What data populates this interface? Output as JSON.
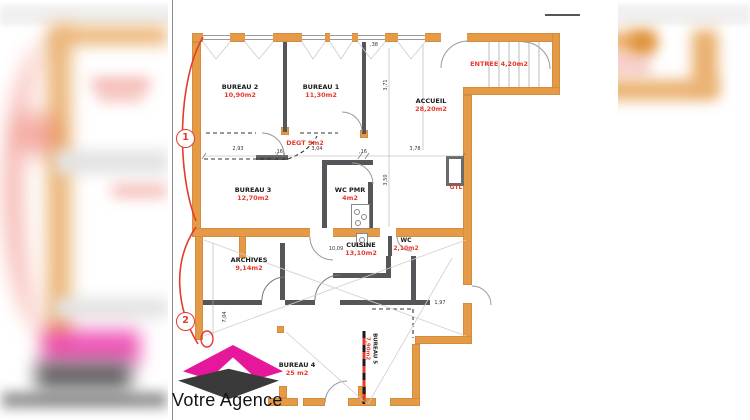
{
  "colors": {
    "wall": "#E49A47",
    "accent_red": "#E63A2E",
    "logo_pink": "#E5179B",
    "logo_dark": "#3A3A3A",
    "partition": "#56565A"
  },
  "plan": {
    "rooms": {
      "bureau2": {
        "name": "BUREAU 2",
        "area": "10,90m2"
      },
      "bureau1": {
        "name": "BUREAU 1",
        "area": "11,30m2"
      },
      "accueil": {
        "name": "ACCUEIL",
        "area": "28,20m2"
      },
      "entree": {
        "label": "ENTREE 4,20m2"
      },
      "degt": {
        "label": "DEGT 9m2"
      },
      "bureau3": {
        "name": "BUREAU 3",
        "area": "12,70m2"
      },
      "wc_pmr": {
        "name": "WC PMR",
        "area": "4m2"
      },
      "gtl": {
        "label": "GTL"
      },
      "archives": {
        "name": "ARCHIVES",
        "area": "9,14m2"
      },
      "cuisine": {
        "name": "CUISINE",
        "area": "13,10m2"
      },
      "wc": {
        "name": "WC",
        "area": "2,10m2"
      },
      "bureau4": {
        "name": "BUREAU 4",
        "area": "25 m2"
      },
      "bureau5": {
        "name": "BUREAU 5",
        "area": "7,90m2"
      }
    },
    "zone_markers": {
      "zone1": "1",
      "zone2": "2"
    },
    "dimensions": {
      "d1": "2,93",
      "d2": ",16",
      "d3": "3,04",
      "d4": ",16",
      "d5": "3,78",
      "d6": "3,71",
      "d7": ",38",
      "d8": "3,50",
      "d9": "10,09",
      "d10": "1,97",
      "d11": "7,04"
    }
  },
  "logo": {
    "text": "Votre Agence"
  }
}
